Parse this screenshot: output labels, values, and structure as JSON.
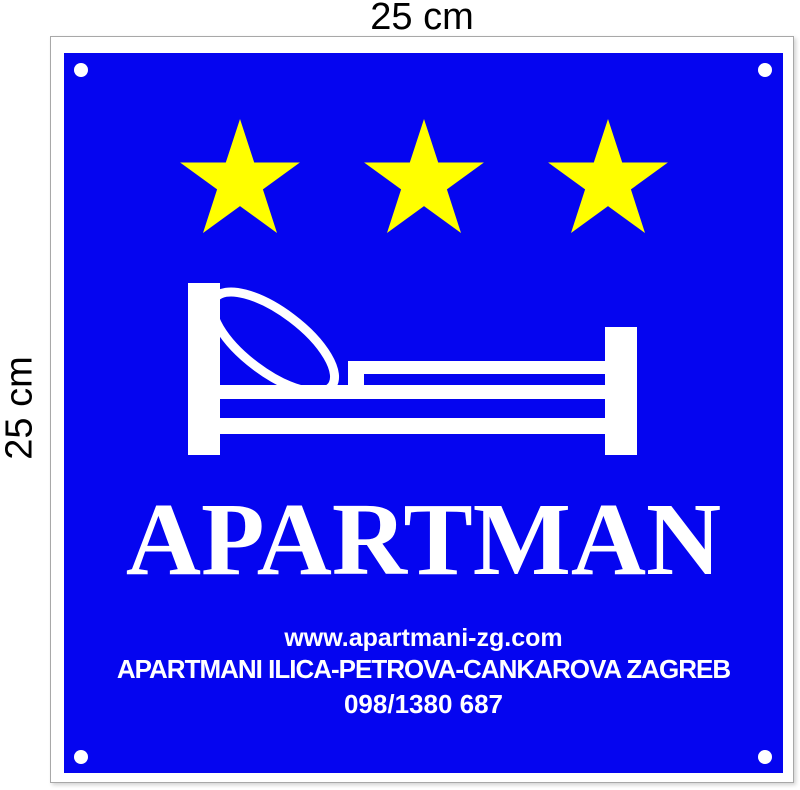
{
  "page": {
    "top_dimension_label": "25 cm",
    "left_dimension_label": "25 cm"
  },
  "sign": {
    "star_count": 3,
    "title": "APARTMAN",
    "website": "www.apartmani-zg.com",
    "address": "APARTMANI ILICA-PETROVA-CANKAROVA ZAGREB",
    "phone": "098/1380 687",
    "colors": {
      "panel_blue": "#0505F0",
      "star_yellow": "#FFFF00",
      "frame_white": "#FFFFFF",
      "text_white": "#FFFFFF",
      "label_black": "#000000"
    }
  }
}
